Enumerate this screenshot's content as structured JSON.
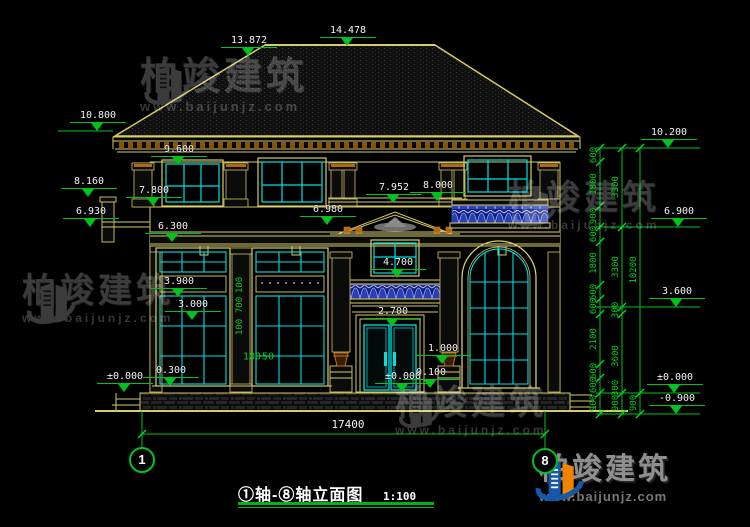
{
  "title_bar": {
    "title": "①轴-⑧轴立面图",
    "scale": "1:100"
  },
  "watermark": {
    "brand": "柏竣建筑",
    "site": "www.baijunjz.com"
  },
  "axis_bubbles": [
    {
      "label": "1",
      "x": 142,
      "y": 460
    },
    {
      "label": "8",
      "x": 545,
      "y": 461
    }
  ],
  "overall_width_dim": {
    "v": "17400",
    "x": 348,
    "y": 431
  },
  "elevation_markers": [
    {
      "value": "13.872",
      "x": 248,
      "y": 56
    },
    {
      "value": "14.478",
      "x": 347,
      "y": 46
    },
    {
      "value": "10.800",
      "x": 97,
      "y": 131
    },
    {
      "value": "9.600",
      "x": 178,
      "y": 165
    },
    {
      "value": "8.160",
      "x": 88,
      "y": 197
    },
    {
      "value": "7.800",
      "x": 153,
      "y": 206
    },
    {
      "value": "6.930",
      "x": 90,
      "y": 227
    },
    {
      "value": "6.300",
      "x": 172,
      "y": 242
    },
    {
      "value": "6.980",
      "x": 327,
      "y": 225
    },
    {
      "value": "7.952",
      "x": 393,
      "y": 203
    },
    {
      "value": "8.000",
      "x": 437,
      "y": 201
    },
    {
      "value": "4.700",
      "x": 397,
      "y": 278
    },
    {
      "value": "3.900",
      "x": 178,
      "y": 297
    },
    {
      "value": "3.000",
      "x": 192,
      "y": 320
    },
    {
      "value": "2.700",
      "x": 392,
      "y": 327
    },
    {
      "value": "1.000",
      "x": 442,
      "y": 364
    },
    {
      "value": "0.100",
      "x": 430,
      "y": 388
    },
    {
      "value": "±0.000",
      "x": 402,
      "y": 392
    },
    {
      "value": "±0.000",
      "x": 124,
      "y": 392
    },
    {
      "value": "0.300",
      "x": 170,
      "y": 386
    },
    {
      "value": "10.200",
      "x": 668,
      "y": 148
    },
    {
      "value": "6.900",
      "x": 678,
      "y": 227
    },
    {
      "value": "3.600",
      "x": 676,
      "y": 307
    },
    {
      "value": "±0.000",
      "x": 674,
      "y": 393
    },
    {
      "value": "-0.900",
      "x": 676,
      "y": 414
    }
  ],
  "right_dim_chains": {
    "inner": {
      "x": 600,
      "labels": [
        {
          "v": "600",
          "y": 155
        },
        {
          "v": "1800",
          "y": 184
        },
        {
          "v": "900",
          "y": 216
        },
        {
          "v": "600",
          "y": 234
        },
        {
          "v": "1800",
          "y": 263
        },
        {
          "v": "600",
          "y": 292
        },
        {
          "v": "600",
          "y": 306
        },
        {
          "v": "2100",
          "y": 339
        },
        {
          "v": "600",
          "y": 371
        },
        {
          "v": "600",
          "y": 385
        },
        {
          "v": "900",
          "y": 403
        }
      ]
    },
    "middle": {
      "x": 622,
      "labels": [
        {
          "v": "3300",
          "y": 187
        },
        {
          "v": "3300",
          "y": 267
        },
        {
          "v": "300",
          "y": 310
        },
        {
          "v": "3600",
          "y": 356
        },
        {
          "v": "300",
          "y": 388
        },
        {
          "v": "900",
          "y": 403
        }
      ]
    },
    "outer": {
      "x": 640,
      "labels": [
        {
          "v": "10200",
          "y": 270
        },
        {
          "v": "900",
          "y": 403
        }
      ]
    }
  },
  "inter_window_dims": [
    {
      "v": "100",
      "x": 240,
      "y": 285
    },
    {
      "v": "700",
      "x": 240,
      "y": 305
    },
    {
      "v": "100",
      "x": 240,
      "y": 327
    }
  ],
  "sill_dims": [
    {
      "v": "100",
      "x": 252,
      "y": 357
    },
    {
      "v": "50",
      "x": 268,
      "y": 357
    }
  ],
  "colors": {
    "line_yellow": "#d6cb6a",
    "cad_cyan": "#00e1e1",
    "dim_green": "#00c31e",
    "text_white": "#f2f2f2",
    "railing_blue": "#1f2f9e",
    "accent_orange": "#c8731f",
    "logo_blue": "#1558a8",
    "logo_orange": "#f08300"
  }
}
